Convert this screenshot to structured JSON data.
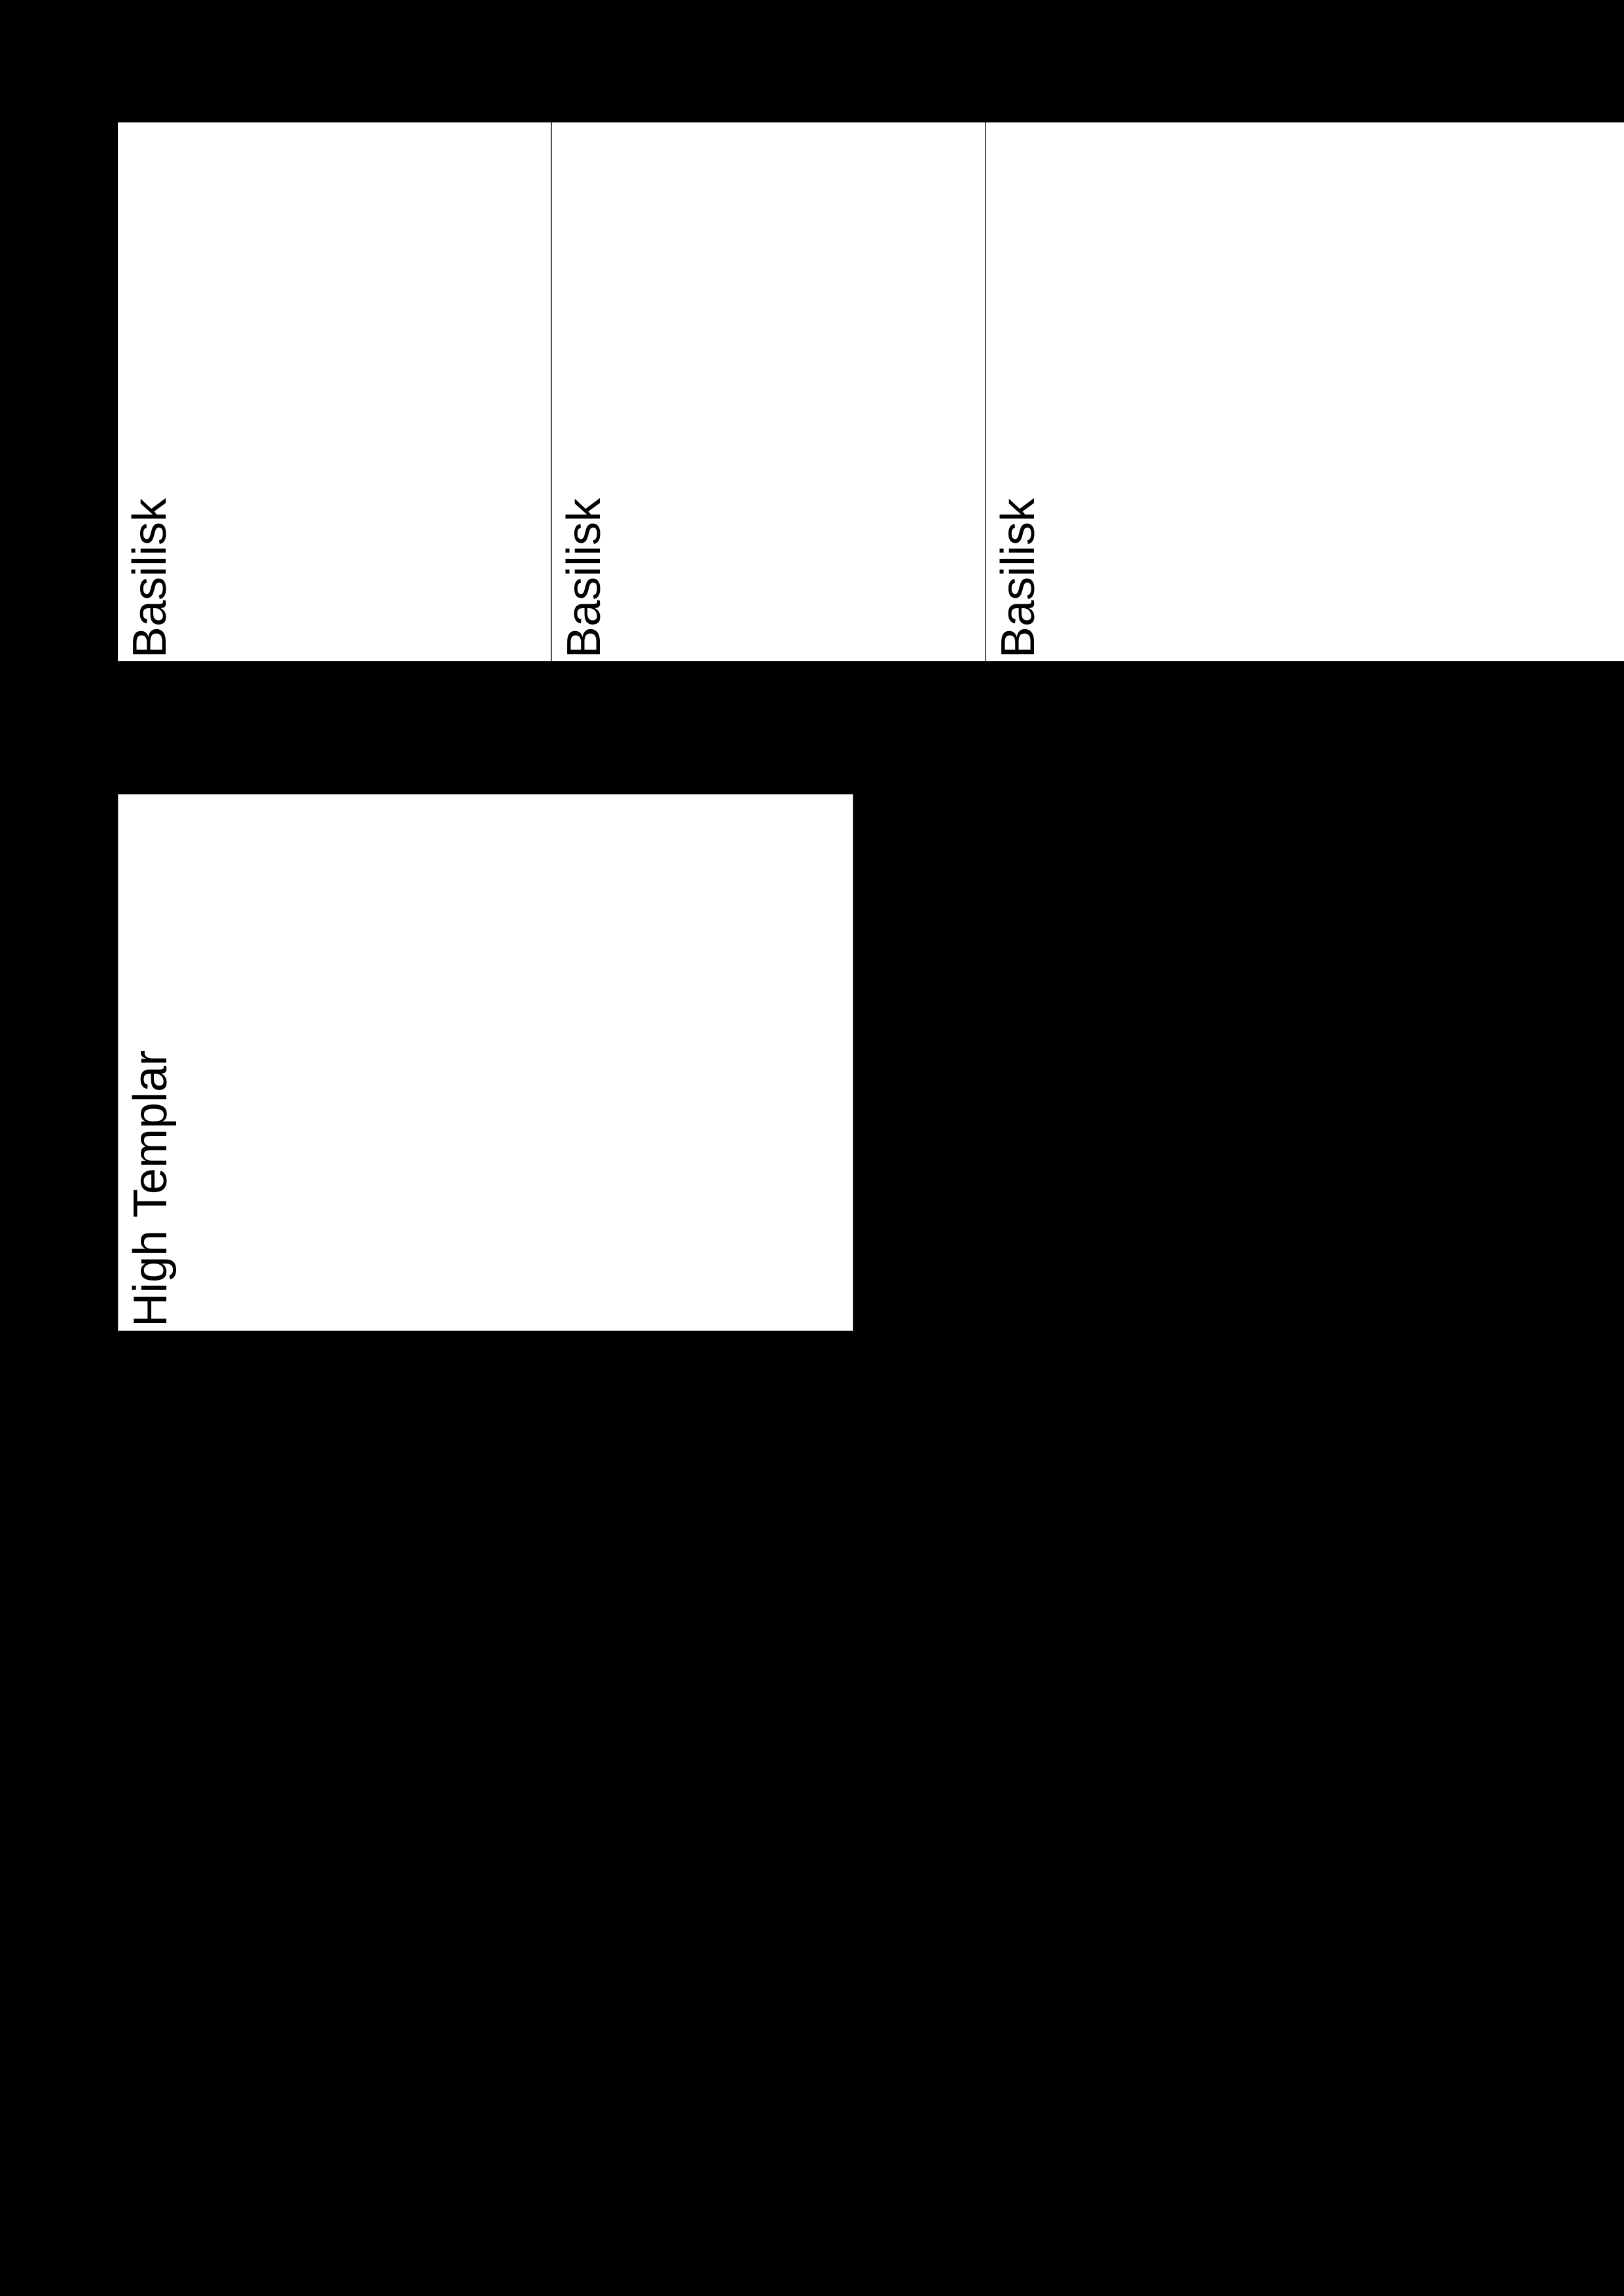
{
  "document": {
    "description": "Printable card sheet rendered on transparent (black) background",
    "cards": [
      {
        "name": "Basilisk"
      },
      {
        "name": "Basilisk"
      },
      {
        "name": "Basilisk"
      },
      {
        "name": "High Templar"
      }
    ],
    "colors": {
      "page_background": "#000000",
      "card_background": "#ffffff",
      "card_text": "#000000",
      "card_divider": "#4f4f4f",
      "card_edge_seam": "#b5b5b5"
    }
  }
}
